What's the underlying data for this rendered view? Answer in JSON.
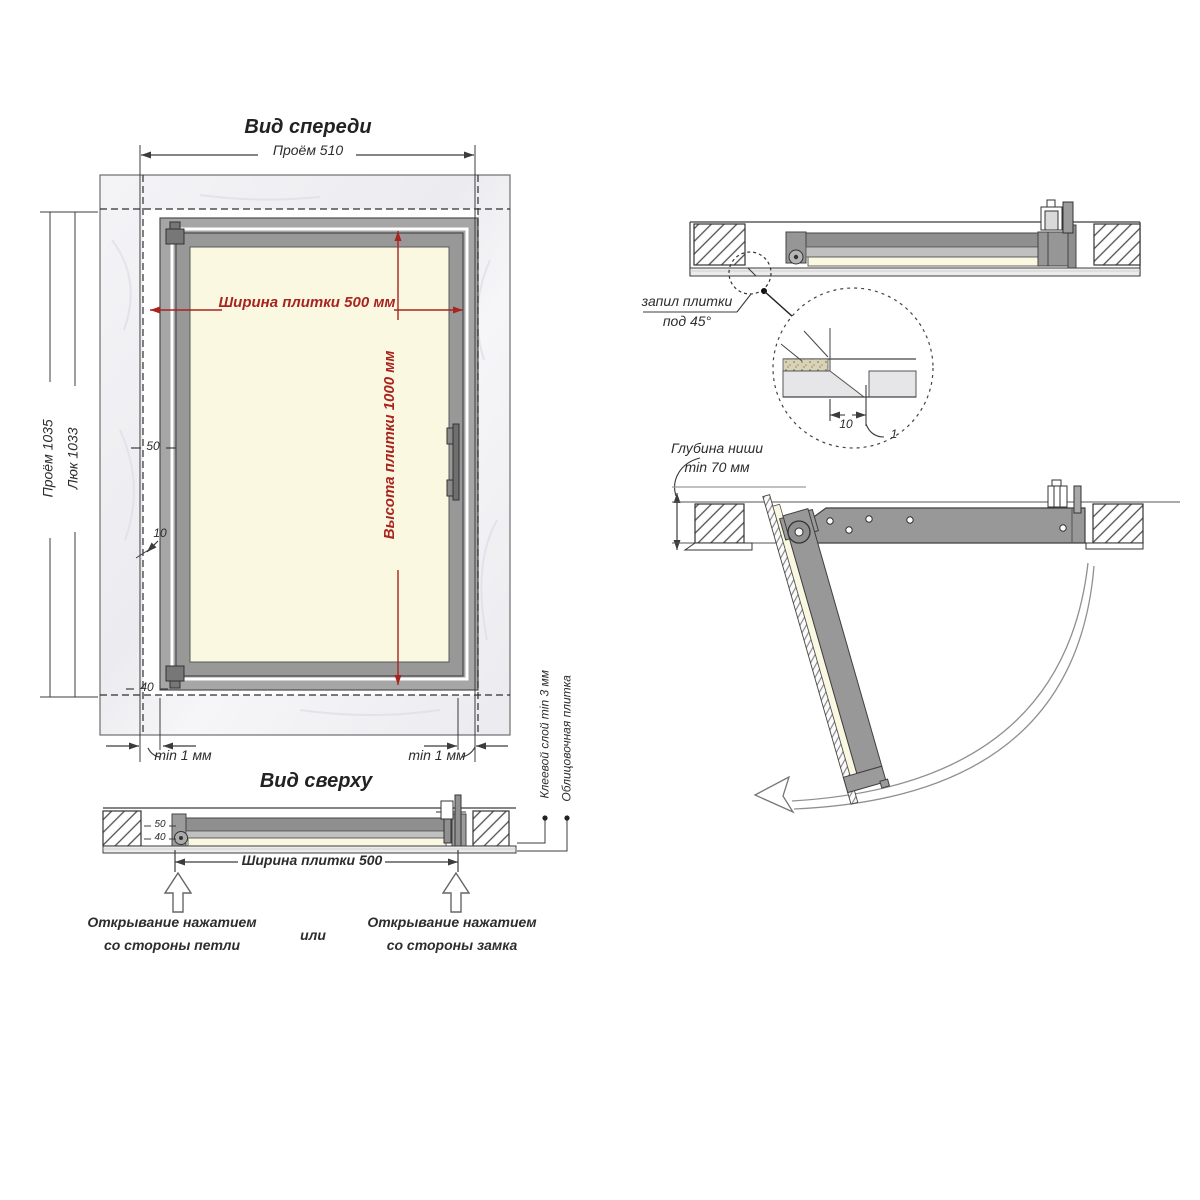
{
  "palette": {
    "dim_red": "#a8241f",
    "line": "#3c3c3c",
    "frame_gray": "#989898",
    "panel_cream": "#fbf8e2",
    "wall_light": "#f2f2f5",
    "tile_fill": "#ececec"
  },
  "front_view": {
    "title": "Вид спереди",
    "dim_opening_width": "Проём 510",
    "dim_tile_width": "Ширина плитки 500 мм",
    "dim_tile_height": "Высота плитки 1000 мм",
    "dim_opening_height": "Проём 1035",
    "dim_hatch_height": "Люк 1033",
    "dim_50": "50",
    "dim_10": "10",
    "dim_40": "40",
    "gap_left": "min 1 мм",
    "gap_right": "min 1 мм"
  },
  "top_view": {
    "title": "Вид сверху",
    "dim_50": "50",
    "dim_40": "40",
    "dim_tile_width": "Ширина плитки 500",
    "open_hinge_line1": "Открывание нажатием",
    "open_hinge_line2": "со стороны петли",
    "or_label": "или",
    "open_lock_line1": "Открывание нажатием",
    "open_lock_line2": "со стороны замка",
    "adhesive_label": "Клеевой слой min 3 мм",
    "tile_label": "Облицовочная плитка"
  },
  "section_closed": {
    "cut_line1": "запил плитки",
    "cut_line2": "под 45°",
    "detail_dim_10": "10",
    "detail_dim_1": "1"
  },
  "section_open": {
    "depth_line1": "Глубина ниши",
    "depth_line2": "min 70 мм"
  }
}
